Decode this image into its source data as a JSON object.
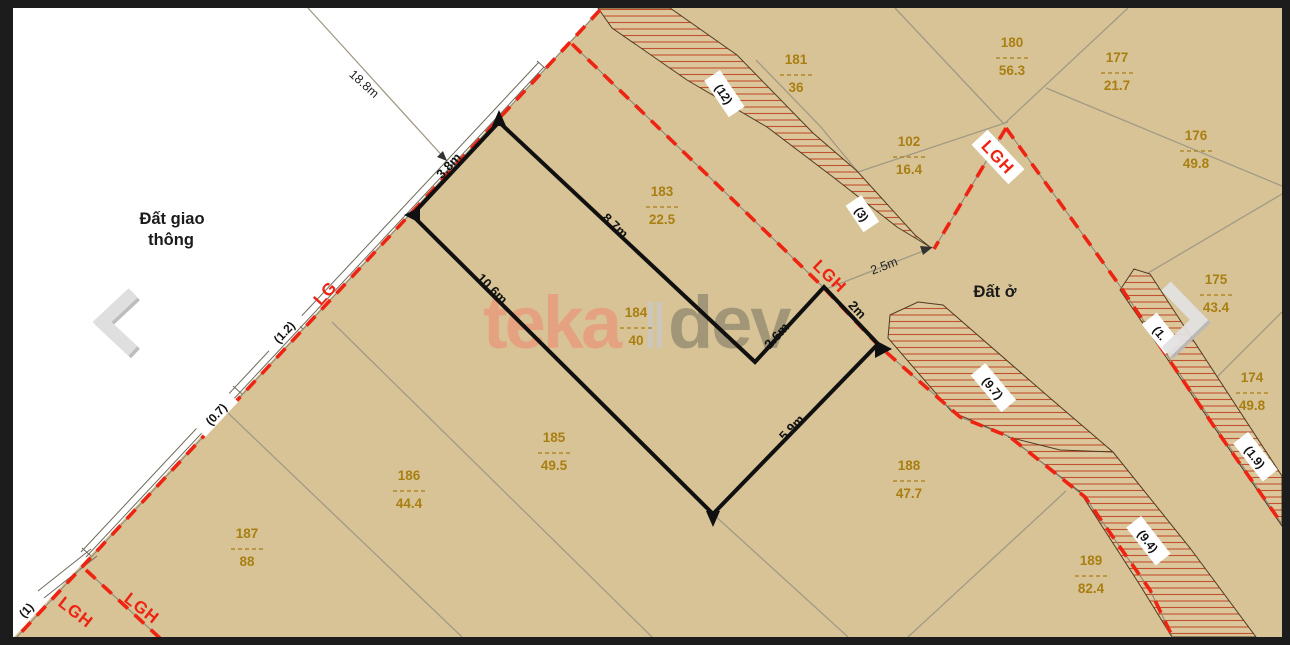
{
  "viewer": {
    "prev_label": "previous",
    "next_label": "next"
  },
  "map": {
    "zones": {
      "traffic_line1": "Đất giao",
      "traffic_line2": "thông",
      "residential": "Đất ở"
    },
    "watermark": {
      "left": "teka",
      "right": "dev"
    },
    "parcels": [
      {
        "number": "181",
        "area": "36"
      },
      {
        "number": "102",
        "area": "16.4"
      },
      {
        "number": "180",
        "area": "56.3"
      },
      {
        "number": "177",
        "area": "21.7"
      },
      {
        "number": "176",
        "area": "49.8"
      },
      {
        "number": "175",
        "area": "43.4"
      },
      {
        "number": "174",
        "area": "49.8"
      },
      {
        "number": "183",
        "area": "22.5"
      },
      {
        "number": "184",
        "area": "40"
      },
      {
        "number": "185",
        "area": "49.5"
      },
      {
        "number": "186",
        "area": "44.4"
      },
      {
        "number": "187",
        "area": "88"
      },
      {
        "number": "188",
        "area": "47.7"
      },
      {
        "number": "189",
        "area": "82.4"
      }
    ],
    "road_widths": [
      "(12)",
      "(3)",
      "(9.7)",
      "(9.4)",
      "(1.9)",
      "(1.",
      "(1.2)",
      "(0.7)",
      "(1)"
    ],
    "red_labels": [
      "LG",
      "LGH",
      "LGH",
      "LGH",
      "LGH"
    ],
    "dimensions": [
      "18.8m",
      "3.8m",
      "8.7m",
      "10.6m",
      "2.6m",
      "2m",
      "2.5m",
      "5.9m"
    ],
    "colors": {
      "land": "#d7c396",
      "hatch_line": "#c2512e",
      "boundary_red": "#ee2413",
      "parcel_text": "#a97f12"
    }
  }
}
